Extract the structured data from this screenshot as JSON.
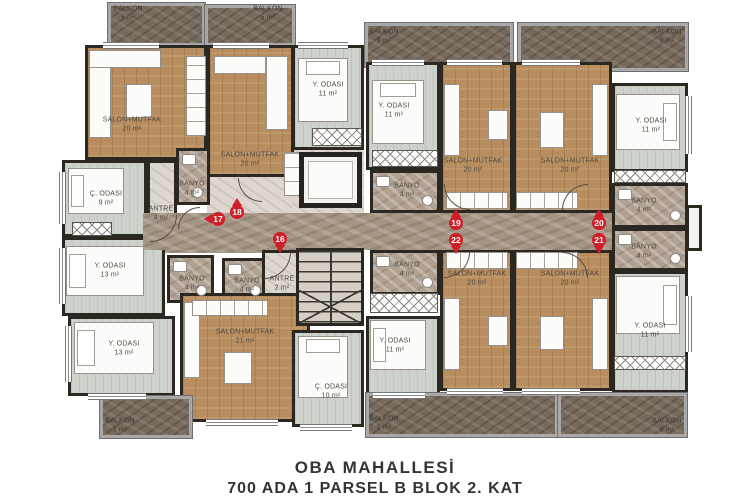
{
  "title": {
    "line1": "OBA MAHALLESİ",
    "line2": "700 ADA 1 PARSEL B BLOK 2. KAT"
  },
  "colors": {
    "wall": "#2b2721",
    "wood_floor": "#b88d5f",
    "bedroom_floor": "#cdd2cb",
    "bath_marble": "#b1a193",
    "corridor_marble": "#a59585",
    "balcony_marble": "#776a5d",
    "pin_red": "#ce1e26",
    "label_text": "#4e4a44",
    "caption_text": "#343434"
  },
  "rooms": [
    {
      "name": "BALKON",
      "area": "5 m²",
      "floor": "balcony",
      "x": 108,
      "y": 3,
      "w": 97,
      "h": 43,
      "lx": 128,
      "ly": 14
    },
    {
      "name": "BALKON",
      "area": "5 m²",
      "floor": "balcony",
      "x": 205,
      "y": 5,
      "w": 90,
      "h": 41,
      "lx": 268,
      "ly": 14
    },
    {
      "name": "BALKON",
      "area": "9 m²",
      "floor": "balcony",
      "x": 365,
      "y": 23,
      "w": 148,
      "h": 44,
      "lx": 384,
      "ly": 37
    },
    {
      "name": "BALKON",
      "area": "9 m²",
      "floor": "balcony",
      "x": 518,
      "y": 23,
      "w": 170,
      "h": 48,
      "lx": 667,
      "ly": 37
    },
    {
      "name": "SALON+MUTFAK",
      "area": "20 m²",
      "floor": "wood",
      "x": 85,
      "y": 45,
      "w": 122,
      "h": 115,
      "lx": 132,
      "ly": 125
    },
    {
      "name": "SALON+MUTFAK",
      "area": "20 m²",
      "floor": "wood",
      "x": 207,
      "y": 45,
      "w": 87,
      "h": 132,
      "lx": 250,
      "ly": 160
    },
    {
      "name": "Y. ODASI",
      "area": "11 m²",
      "floor": "bedroom",
      "x": 292,
      "y": 45,
      "w": 72,
      "h": 105,
      "lx": 328,
      "ly": 90
    },
    {
      "name": "Y. ODASI",
      "area": "11 m²",
      "floor": "bedroom",
      "x": 366,
      "y": 62,
      "w": 74,
      "h": 108,
      "lx": 394,
      "ly": 111
    },
    {
      "name": "SALON+MUTFAK",
      "area": "20 m²",
      "floor": "wood",
      "x": 440,
      "y": 62,
      "w": 73,
      "h": 151,
      "lx": 473,
      "ly": 166
    },
    {
      "name": "SALON+MUTFAK",
      "area": "20 m²",
      "floor": "wood",
      "x": 513,
      "y": 62,
      "w": 99,
      "h": 151,
      "lx": 570,
      "ly": 166
    },
    {
      "name": "Y. ODASI",
      "area": "11 m²",
      "floor": "bedroom",
      "x": 612,
      "y": 83,
      "w": 76,
      "h": 89,
      "lx": 651,
      "ly": 126
    },
    {
      "name": "Ç. ODASI",
      "area": "9 m²",
      "floor": "bedroom",
      "x": 62,
      "y": 160,
      "w": 85,
      "h": 77,
      "lx": 106,
      "ly": 199
    },
    {
      "name": "ANTRE",
      "area": "4 m²",
      "floor": "hall",
      "x": 147,
      "y": 160,
      "w": 30,
      "h": 77,
      "lx": 161,
      "ly": 214
    },
    {
      "name": "BANYO",
      "area": "4 m²",
      "floor": "bath",
      "x": 176,
      "y": 148,
      "w": 34,
      "h": 57,
      "lx": 192,
      "ly": 189
    },
    {
      "name": "Y. ODASI",
      "area": "13 m²",
      "floor": "bedroom",
      "x": 62,
      "y": 237,
      "w": 103,
      "h": 79,
      "lx": 110,
      "ly": 271
    },
    {
      "name": "BANYO",
      "area": "4 m²",
      "floor": "bath",
      "x": 167,
      "y": 255,
      "w": 47,
      "h": 48,
      "lx": 192,
      "ly": 284
    },
    {
      "name": "BANYO",
      "area": "4 m²",
      "floor": "bath",
      "x": 222,
      "y": 258,
      "w": 46,
      "h": 45,
      "lx": 247,
      "ly": 286
    },
    {
      "name": "ANTRE",
      "area": "2 m²",
      "floor": "hall",
      "x": 262,
      "y": 250,
      "w": 46,
      "h": 54,
      "lx": 282,
      "ly": 284
    },
    {
      "name": "Y. ODASI",
      "area": "13 m²",
      "floor": "bedroom",
      "x": 68,
      "y": 316,
      "w": 107,
      "h": 80,
      "lx": 124,
      "ly": 349
    },
    {
      "name": "SALON+MUTFAK",
      "area": "21 m²",
      "floor": "wood",
      "x": 180,
      "y": 293,
      "w": 130,
      "h": 129,
      "lx": 245,
      "ly": 337
    },
    {
      "name": "Ç. ODASI",
      "area": "10 m²",
      "floor": "bedroom",
      "x": 292,
      "y": 330,
      "w": 72,
      "h": 97,
      "lx": 331,
      "ly": 392
    },
    {
      "name": "Y. ODASI",
      "area": "11 m²",
      "floor": "bedroom",
      "x": 366,
      "y": 316,
      "w": 74,
      "h": 79,
      "lx": 395,
      "ly": 346
    },
    {
      "name": "BANYO",
      "area": "4 m²",
      "floor": "bath",
      "x": 370,
      "y": 170,
      "w": 70,
      "h": 43,
      "lx": 407,
      "ly": 191
    },
    {
      "name": "BANYO",
      "area": "4 m²",
      "floor": "bath",
      "x": 370,
      "y": 250,
      "w": 70,
      "h": 45,
      "lx": 407,
      "ly": 270
    },
    {
      "name": "SALON+MUTFAK",
      "area": "20 m²",
      "floor": "wood",
      "x": 440,
      "y": 250,
      "w": 73,
      "h": 141,
      "lx": 477,
      "ly": 279
    },
    {
      "name": "SALON+MUTFAK",
      "area": "20 m²",
      "floor": "wood",
      "x": 513,
      "y": 250,
      "w": 99,
      "h": 141,
      "lx": 570,
      "ly": 279
    },
    {
      "name": "BANYO",
      "area": "4 m²",
      "floor": "bath",
      "x": 612,
      "y": 183,
      "w": 76,
      "h": 45,
      "lx": 644,
      "ly": 206
    },
    {
      "name": "BANYO",
      "area": "4 m²",
      "floor": "bath",
      "x": 612,
      "y": 228,
      "w": 76,
      "h": 43,
      "lx": 644,
      "ly": 252
    },
    {
      "name": "Y. ODASI",
      "area": "11 m²",
      "floor": "bedroom",
      "x": 612,
      "y": 271,
      "w": 76,
      "h": 122,
      "lx": 650,
      "ly": 331
    },
    {
      "name": "BALKON",
      "area": "5 m²",
      "floor": "balcony",
      "x": 100,
      "y": 396,
      "w": 92,
      "h": 42,
      "lx": 120,
      "ly": 426
    },
    {
      "name": "BALKON",
      "area": "9 m²",
      "floor": "balcony",
      "x": 366,
      "y": 393,
      "w": 192,
      "h": 44,
      "lx": 384,
      "ly": 424
    },
    {
      "name": "BALKON",
      "area": "9 m²",
      "floor": "balcony",
      "x": 558,
      "y": 393,
      "w": 129,
      "h": 44,
      "lx": 667,
      "ly": 426
    }
  ],
  "fills": [
    {
      "floor": "hall",
      "x": 207,
      "y": 177,
      "w": 87,
      "h": 38
    },
    {
      "floor": "hall",
      "x": 292,
      "y": 150,
      "w": 72,
      "h": 65
    },
    {
      "floor": "corridor",
      "x": 160,
      "y": 237,
      "w": 148,
      "h": 16
    }
  ],
  "structures": {
    "corridor": {
      "x": 143,
      "y": 213,
      "w": 469,
      "h": 37
    },
    "elevator": {
      "x": 299,
      "y": 152,
      "w": 63,
      "h": 56
    },
    "stairs": {
      "x": 296,
      "y": 248,
      "w": 68,
      "h": 78
    },
    "shaft": {
      "x": 686,
      "y": 205,
      "w": 16,
      "h": 46
    }
  },
  "pins": [
    {
      "num": "17",
      "x": 218,
      "y": 219,
      "dir": "left"
    },
    {
      "num": "18",
      "x": 237,
      "y": 212,
      "dir": "up"
    },
    {
      "num": "16",
      "x": 280,
      "y": 239,
      "dir": "down"
    },
    {
      "num": "19",
      "x": 456,
      "y": 223,
      "dir": "up"
    },
    {
      "num": "22",
      "x": 456,
      "y": 240,
      "dir": "down"
    },
    {
      "num": "20",
      "x": 599,
      "y": 223,
      "dir": "up"
    },
    {
      "num": "21",
      "x": 599,
      "y": 240,
      "dir": "down"
    }
  ],
  "closets": [
    {
      "x": 372,
      "y": 150,
      "w": 66,
      "h": 17
    },
    {
      "x": 312,
      "y": 128,
      "w": 50,
      "h": 18
    },
    {
      "x": 370,
      "y": 293,
      "w": 68,
      "h": 20
    },
    {
      "x": 614,
      "y": 170,
      "w": 72,
      "h": 13
    },
    {
      "x": 614,
      "y": 356,
      "w": 72,
      "h": 14
    },
    {
      "x": 72,
      "y": 222,
      "w": 40,
      "h": 14
    }
  ],
  "furniture": [
    {
      "t": "bed",
      "x": 298,
      "y": 58,
      "w": 50,
      "h": 64,
      "p": "top"
    },
    {
      "t": "bed",
      "x": 372,
      "y": 80,
      "w": 52,
      "h": 64,
      "p": "top"
    },
    {
      "t": "bed",
      "x": 616,
      "y": 94,
      "w": 64,
      "h": 56,
      "p": "right"
    },
    {
      "t": "bed",
      "x": 68,
      "y": 168,
      "w": 56,
      "h": 46,
      "p": "left"
    },
    {
      "t": "bed",
      "x": 66,
      "y": 246,
      "w": 78,
      "h": 50,
      "p": "left"
    },
    {
      "t": "bed",
      "x": 74,
      "y": 322,
      "w": 80,
      "h": 52,
      "p": "left"
    },
    {
      "t": "bed",
      "x": 298,
      "y": 336,
      "w": 50,
      "h": 62,
      "p": "top"
    },
    {
      "t": "bed",
      "x": 370,
      "y": 320,
      "w": 56,
      "h": 50,
      "p": "left"
    },
    {
      "t": "bed",
      "x": 616,
      "y": 276,
      "w": 64,
      "h": 58,
      "p": "right"
    },
    {
      "t": "sofa",
      "x": 89,
      "y": 50,
      "w": 22,
      "h": 88
    },
    {
      "t": "sofa",
      "x": 89,
      "y": 50,
      "w": 72,
      "h": 18
    },
    {
      "t": "sofa",
      "x": 266,
      "y": 56,
      "w": 22,
      "h": 74
    },
    {
      "t": "sofa",
      "x": 214,
      "y": 56,
      "w": 52,
      "h": 18
    },
    {
      "t": "sofa",
      "x": 444,
      "y": 84,
      "w": 16,
      "h": 72
    },
    {
      "t": "sofa",
      "x": 592,
      "y": 84,
      "w": 16,
      "h": 72
    },
    {
      "t": "sofa",
      "x": 444,
      "y": 298,
      "w": 16,
      "h": 72
    },
    {
      "t": "sofa",
      "x": 592,
      "y": 298,
      "w": 16,
      "h": 72
    },
    {
      "t": "sofa",
      "x": 184,
      "y": 302,
      "w": 16,
      "h": 76
    },
    {
      "t": "box",
      "x": 126,
      "y": 84,
      "w": 26,
      "h": 34
    },
    {
      "t": "box",
      "x": 488,
      "y": 110,
      "w": 20,
      "h": 30
    },
    {
      "t": "box",
      "x": 540,
      "y": 112,
      "w": 24,
      "h": 36
    },
    {
      "t": "box",
      "x": 488,
      "y": 316,
      "w": 20,
      "h": 30
    },
    {
      "t": "box",
      "x": 540,
      "y": 316,
      "w": 24,
      "h": 34
    },
    {
      "t": "box",
      "x": 224,
      "y": 352,
      "w": 28,
      "h": 32
    },
    {
      "t": "counter",
      "x": 186,
      "y": 56,
      "w": 20,
      "h": 80,
      "v": true
    },
    {
      "t": "counter",
      "x": 284,
      "y": 152,
      "w": 22,
      "h": 44,
      "v": true
    },
    {
      "t": "counter",
      "x": 446,
      "y": 192,
      "w": 62,
      "h": 17
    },
    {
      "t": "counter",
      "x": 516,
      "y": 192,
      "w": 62,
      "h": 17
    },
    {
      "t": "counter",
      "x": 446,
      "y": 252,
      "w": 62,
      "h": 17
    },
    {
      "t": "counter",
      "x": 516,
      "y": 252,
      "w": 62,
      "h": 17
    },
    {
      "t": "counter",
      "x": 192,
      "y": 300,
      "w": 76,
      "h": 16
    }
  ],
  "windows": [
    {
      "t": "h",
      "x": 103,
      "y": 42,
      "w": 56
    },
    {
      "t": "h",
      "x": 213,
      "y": 42,
      "w": 56
    },
    {
      "t": "h",
      "x": 298,
      "y": 42,
      "w": 50
    },
    {
      "t": "h",
      "x": 372,
      "y": 59,
      "w": 52
    },
    {
      "t": "h",
      "x": 447,
      "y": 59,
      "w": 55
    },
    {
      "t": "h",
      "x": 522,
      "y": 59,
      "w": 58
    },
    {
      "t": "v",
      "x": 685,
      "y": 96,
      "h": 58
    },
    {
      "t": "v",
      "x": 59,
      "y": 172,
      "h": 52
    },
    {
      "t": "v",
      "x": 59,
      "y": 248,
      "h": 56
    },
    {
      "t": "v",
      "x": 65,
      "y": 326,
      "h": 56
    },
    {
      "t": "h",
      "x": 88,
      "y": 393,
      "w": 58
    },
    {
      "t": "h",
      "x": 206,
      "y": 419,
      "w": 72
    },
    {
      "t": "h",
      "x": 300,
      "y": 424,
      "w": 52
    },
    {
      "t": "h",
      "x": 373,
      "y": 392,
      "w": 52
    },
    {
      "t": "h",
      "x": 447,
      "y": 388,
      "w": 56
    },
    {
      "t": "h",
      "x": 522,
      "y": 388,
      "w": 58
    },
    {
      "t": "v",
      "x": 685,
      "y": 296,
      "h": 56
    }
  ],
  "doors": [
    {
      "x": 150,
      "y": 215,
      "r": 27,
      "rot": 90
    },
    {
      "x": 238,
      "y": 178,
      "r": 24,
      "rot": 180
    },
    {
      "x": 264,
      "y": 252,
      "r": 27,
      "rot": 90
    },
    {
      "x": 444,
      "y": 184,
      "r": 26,
      "rot": 180
    },
    {
      "x": 444,
      "y": 252,
      "r": 26,
      "rot": 90
    },
    {
      "x": 562,
      "y": 184,
      "r": 26,
      "rot": 270
    },
    {
      "x": 562,
      "y": 252,
      "r": 26,
      "rot": 0
    },
    {
      "x": 178,
      "y": 207,
      "r": 22,
      "rot": 270
    }
  ]
}
